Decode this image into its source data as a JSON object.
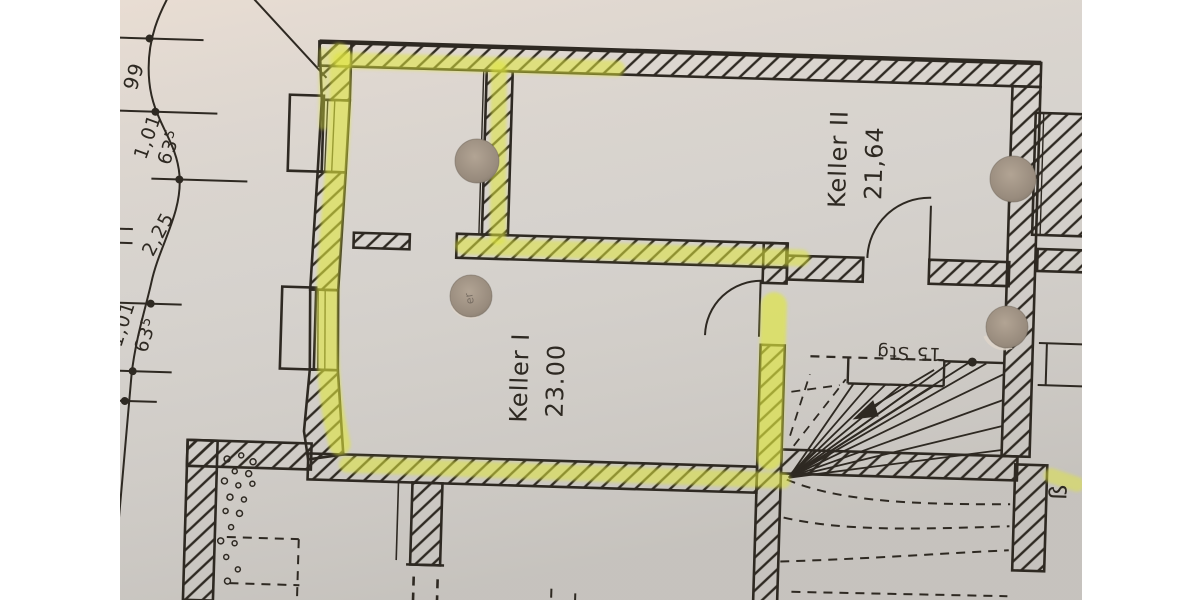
{
  "photo": {
    "description": "scanned basement floor plan with highlighter marks and punch holes",
    "rooms": [
      {
        "name": "Keller I",
        "area": "23.00"
      },
      {
        "name": "Keller II",
        "area": "21,64"
      }
    ],
    "stairs": {
      "count_label": "15 Stg"
    },
    "dimensions": {
      "d1": "99",
      "d2": "1,01",
      "d3_main": "63",
      "d3_sup": "5",
      "d4": "2,25",
      "d5": "1,01",
      "d6_main": "63",
      "d6_sup": "5"
    },
    "edge_label": "ß",
    "hole_note": "er",
    "colors": {
      "paper": "#d6d2cd",
      "ink": "#2e2922",
      "highlight": "#dfe63d",
      "hole": "#9d9083"
    }
  }
}
